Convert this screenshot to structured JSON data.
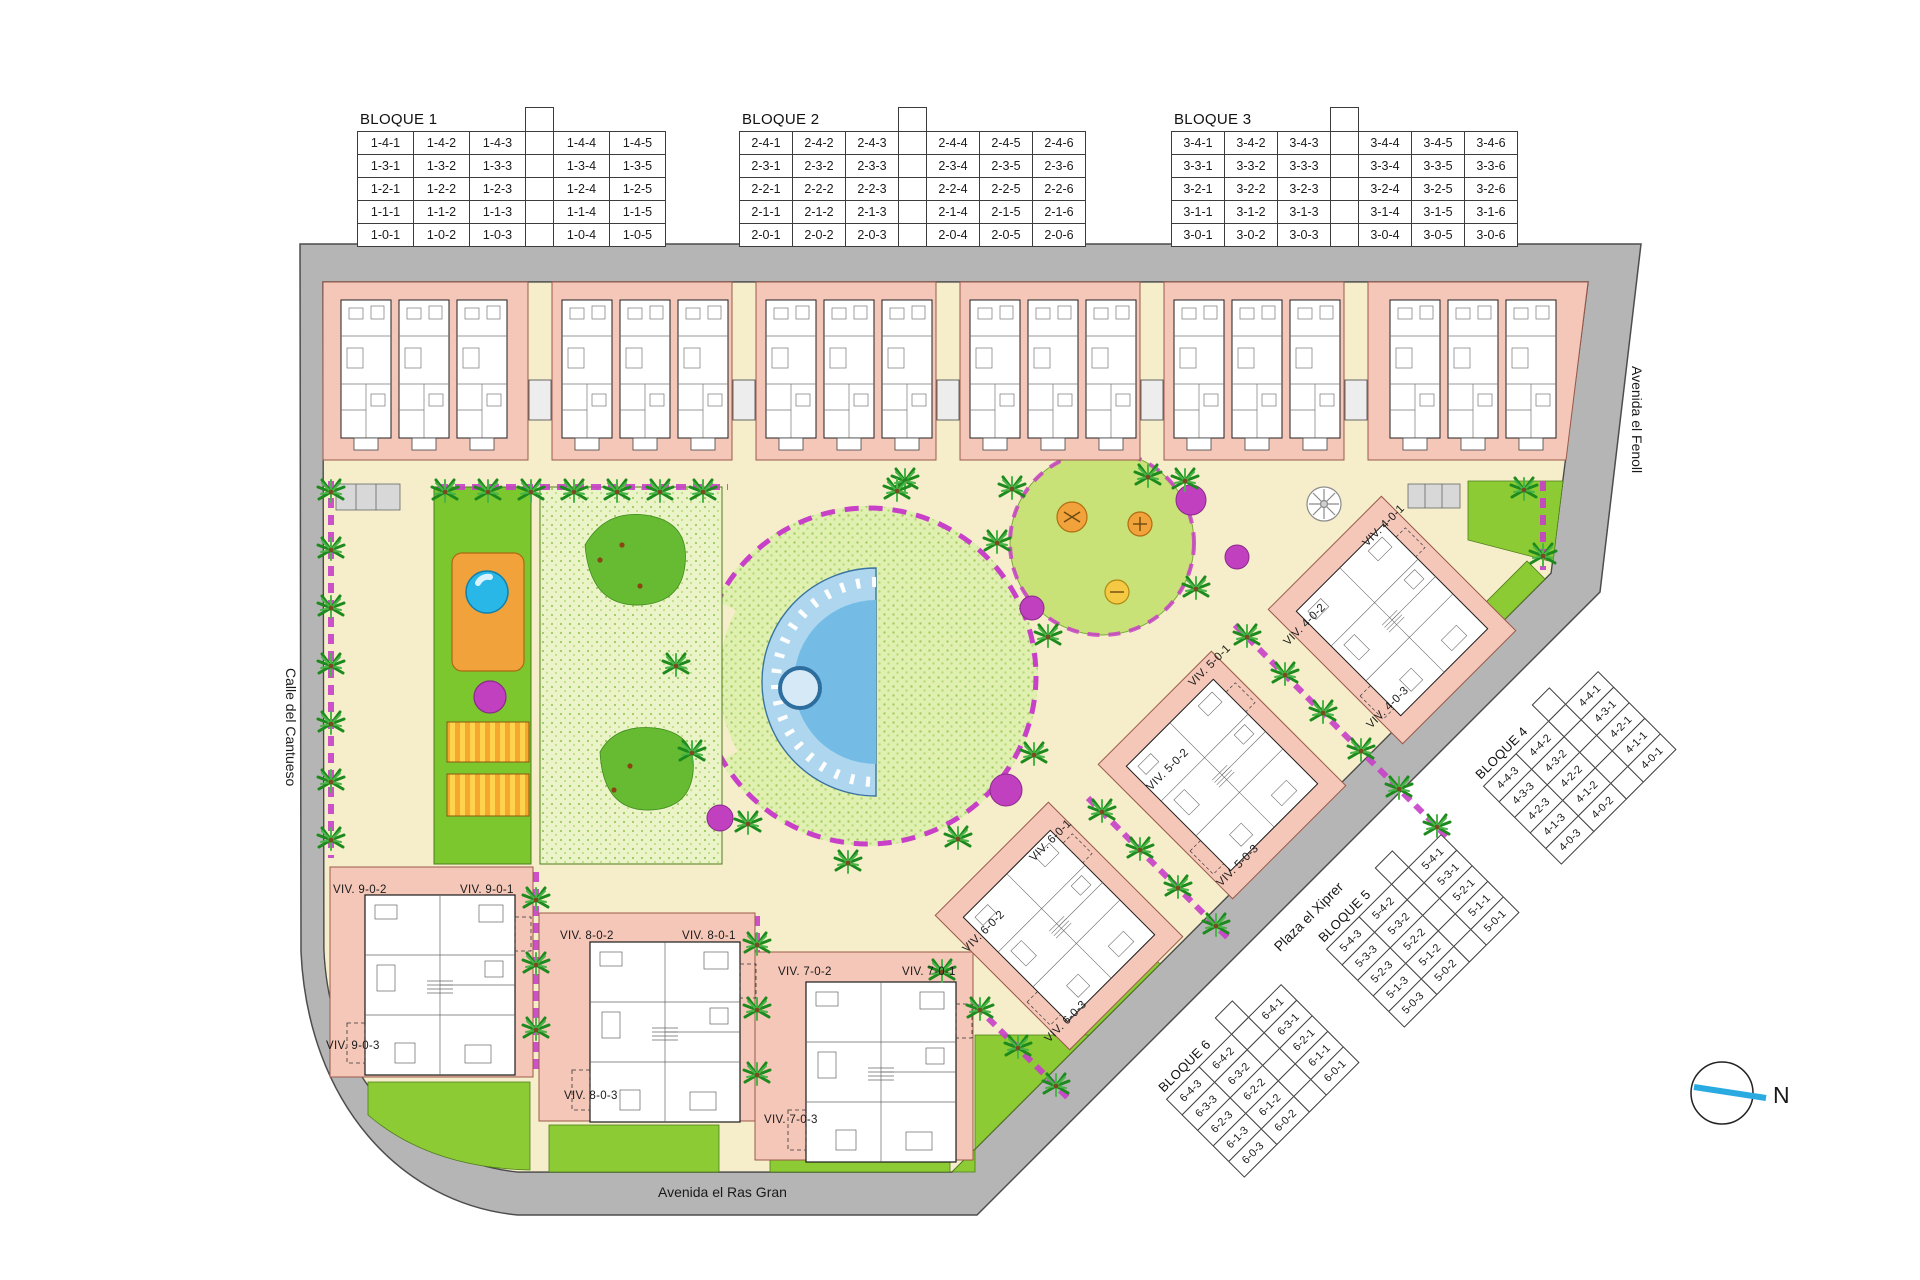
{
  "north_label": "N",
  "streets": {
    "right_vertical": "Avenida el Fenoll",
    "left_vertical": "Calle del Cantueso",
    "bottom": "Avenida el Ras Gran",
    "diagonal": "Plaza el Xiprer"
  },
  "unit_tables": {
    "bloque1": {
      "title": "BLOQUE 1",
      "gap_after": 3,
      "rows": [
        [
          "1-4-1",
          "1-4-2",
          "1-4-3",
          "1-4-4",
          "1-4-5"
        ],
        [
          "1-3-1",
          "1-3-2",
          "1-3-3",
          "1-3-4",
          "1-3-5"
        ],
        [
          "1-2-1",
          "1-2-2",
          "1-2-3",
          "1-2-4",
          "1-2-5"
        ],
        [
          "1-1-1",
          "1-1-2",
          "1-1-3",
          "1-1-4",
          "1-1-5"
        ],
        [
          "1-0-1",
          "1-0-2",
          "1-0-3",
          "1-0-4",
          "1-0-5"
        ]
      ]
    },
    "bloque2": {
      "title": "BLOQUE 2",
      "gap_after": 3,
      "rows": [
        [
          "2-4-1",
          "2-4-2",
          "2-4-3",
          "2-4-4",
          "2-4-5",
          "2-4-6"
        ],
        [
          "2-3-1",
          "2-3-2",
          "2-3-3",
          "2-3-4",
          "2-3-5",
          "2-3-6"
        ],
        [
          "2-2-1",
          "2-2-2",
          "2-2-3",
          "2-2-4",
          "2-2-5",
          "2-2-6"
        ],
        [
          "2-1-1",
          "2-1-2",
          "2-1-3",
          "2-1-4",
          "2-1-5",
          "2-1-6"
        ],
        [
          "2-0-1",
          "2-0-2",
          "2-0-3",
          "2-0-4",
          "2-0-5",
          "2-0-6"
        ]
      ]
    },
    "bloque3": {
      "title": "BLOQUE 3",
      "gap_after": 3,
      "rows": [
        [
          "3-4-1",
          "3-4-2",
          "3-4-3",
          "3-4-4",
          "3-4-5",
          "3-4-6"
        ],
        [
          "3-3-1",
          "3-3-2",
          "3-3-3",
          "3-3-4",
          "3-3-5",
          "3-3-6"
        ],
        [
          "3-2-1",
          "3-2-2",
          "3-2-3",
          "3-2-4",
          "3-2-5",
          "3-2-6"
        ],
        [
          "3-1-1",
          "3-1-2",
          "3-1-3",
          "3-1-4",
          "3-1-5",
          "3-1-6"
        ],
        [
          "3-0-1",
          "3-0-2",
          "3-0-3",
          "3-0-4",
          "3-0-5",
          "3-0-6"
        ]
      ]
    },
    "bloque4": {
      "title": "BLOQUE 4",
      "gap_after": 2,
      "rows": [
        [
          "4-4-3",
          "4-4-2",
          "4-4-1"
        ],
        [
          "4-3-3",
          "4-3-2",
          "4-3-1"
        ],
        [
          "4-2-3",
          "4-2-2",
          "4-2-1"
        ],
        [
          "4-1-3",
          "4-1-2",
          "4-1-1"
        ],
        [
          "4-0-3",
          "4-0-2",
          "4-0-1"
        ]
      ]
    },
    "bloque5": {
      "title": "BLOQUE 5",
      "gap_after": 2,
      "rows": [
        [
          "5-4-3",
          "5-4-2",
          "5-4-1"
        ],
        [
          "5-3-3",
          "5-3-2",
          "5-3-1"
        ],
        [
          "5-2-3",
          "5-2-2",
          "5-2-1"
        ],
        [
          "5-1-3",
          "5-1-2",
          "5-1-1"
        ],
        [
          "5-0-3",
          "5-0-2",
          "5-0-1"
        ]
      ]
    },
    "bloque6": {
      "title": "BLOQUE 6",
      "gap_after": 2,
      "rows": [
        [
          "6-4-3",
          "6-4-2",
          "6-4-1"
        ],
        [
          "6-3-3",
          "6-3-2",
          "6-3-1"
        ],
        [
          "6-2-3",
          "6-2-2",
          "6-2-1"
        ],
        [
          "6-1-3",
          "6-1-2",
          "6-1-1"
        ],
        [
          "6-0-3",
          "6-0-2",
          "6-0-1"
        ]
      ]
    }
  },
  "viv_labels": {
    "v902": "VIV. 9-0-2",
    "v901": "VIV. 9-0-1",
    "v903": "VIV. 9-0-3",
    "v802": "VIV. 8-0-2",
    "v801": "VIV. 8-0-1",
    "v803": "VIV. 8-0-3",
    "v702": "VIV. 7-0-2",
    "v701": "VIV. 7-0-1",
    "v703": "VIV. 7-0-3",
    "v401": "VIV. 4-0-1",
    "v402": "VIV. 4-0-2",
    "v403": "VIV. 4-0-3",
    "v501": "VIV. 5-0-1",
    "v502": "VIV. 5-0-2",
    "v503": "VIV. 5-0-3",
    "v601": "VIV. 6-0-1",
    "v602": "VIV. 6-0-2",
    "v603": "VIV. 6-0-3"
  },
  "colors": {
    "plot_pink": "#f4c7b8",
    "path_cream": "#f6eeca",
    "lawn_green": "#8ccb33",
    "flower_magenta": "#c83fc8",
    "pool_blue": "#7ec3ea",
    "road_gray": "#b5b5b5",
    "accent_orange": "#f2a23a",
    "north_cyan": "#29abe2"
  }
}
